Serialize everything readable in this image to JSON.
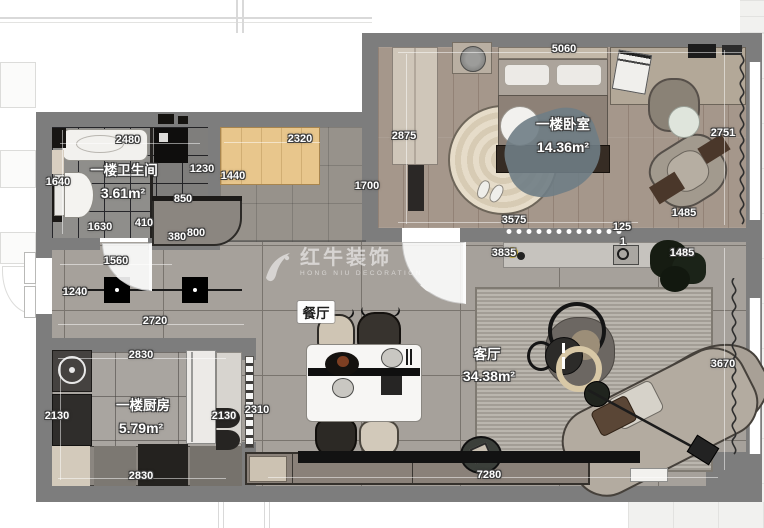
{
  "plan": {
    "watermark": {
      "brand": "红牛装饰",
      "subtitle": "HONG NIU DECORATION"
    },
    "rooms": [
      {
        "name": "一楼卫生间",
        "area": "3.61m²"
      },
      {
        "name": "一楼卧室",
        "area": "14.36m²"
      },
      {
        "name": "一楼厨房",
        "area": "5.79m²"
      },
      {
        "name": "餐厅",
        "area": ""
      },
      {
        "name": "客厅",
        "area": "34.38m²"
      }
    ],
    "dimensions": [
      {
        "t": "5060",
        "x": 564,
        "y": 49
      },
      {
        "t": "2875",
        "x": 404,
        "y": 136
      },
      {
        "t": "2751",
        "x": 723,
        "y": 133
      },
      {
        "t": "2480",
        "x": 128,
        "y": 140
      },
      {
        "t": "2320",
        "x": 300,
        "y": 139
      },
      {
        "t": "1230",
        "x": 202,
        "y": 169
      },
      {
        "t": "1440",
        "x": 233,
        "y": 176
      },
      {
        "t": "1640",
        "x": 58,
        "y": 182
      },
      {
        "t": "1700",
        "x": 367,
        "y": 186
      },
      {
        "t": "850",
        "x": 183,
        "y": 199
      },
      {
        "t": "410",
        "x": 144,
        "y": 223
      },
      {
        "t": "1630",
        "x": 100,
        "y": 227
      },
      {
        "t": "380",
        "x": 177,
        "y": 237
      },
      {
        "t": "800",
        "x": 196,
        "y": 233
      },
      {
        "t": "3575",
        "x": 514,
        "y": 220
      },
      {
        "t": "125",
        "x": 622,
        "y": 227
      },
      {
        "t": "1485",
        "x": 684,
        "y": 213
      },
      {
        "t": "1",
        "x": 623,
        "y": 242
      },
      {
        "t": "3835",
        "x": 504,
        "y": 253
      },
      {
        "t": "1485",
        "x": 682,
        "y": 253
      },
      {
        "t": "1560",
        "x": 116,
        "y": 261
      },
      {
        "t": "1240",
        "x": 75,
        "y": 292
      },
      {
        "t": "2720",
        "x": 155,
        "y": 321
      },
      {
        "t": "2830",
        "x": 141,
        "y": 355
      },
      {
        "t": "2130",
        "x": 57,
        "y": 416
      },
      {
        "t": "2130",
        "x": 224,
        "y": 416
      },
      {
        "t": "2310",
        "x": 257,
        "y": 410
      },
      {
        "t": "2830",
        "x": 141,
        "y": 476
      },
      {
        "t": "3670",
        "x": 723,
        "y": 364
      },
      {
        "t": "7280",
        "x": 489,
        "y": 475
      }
    ]
  }
}
